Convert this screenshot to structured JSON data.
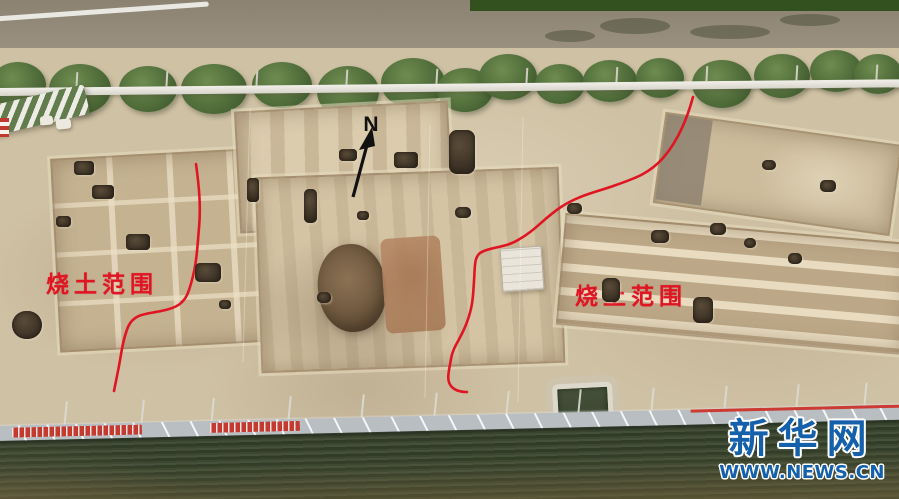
{
  "scene": {
    "type": "aerial photograph",
    "subject": "archaeological excavation site with annotated burnt-soil areas"
  },
  "annotations": {
    "north_label": "N",
    "left_label": "烧土范围",
    "right_label": "烧土范围",
    "annotation_color": "#e01523"
  },
  "watermark": {
    "logo": "新华网",
    "url": "WWW.NEWS.CN",
    "color": "#1560ab"
  },
  "palette": {
    "soil_light": "#cfc1a4",
    "trench_soil": "#c4b291",
    "pit_dark": "#352c21",
    "shrub_green": "#4d6a38",
    "crop_field_green": "#3a462e",
    "road_grey": "#938a78",
    "wall_grey": "#b9bec3",
    "banner_red": "#c23a30"
  }
}
